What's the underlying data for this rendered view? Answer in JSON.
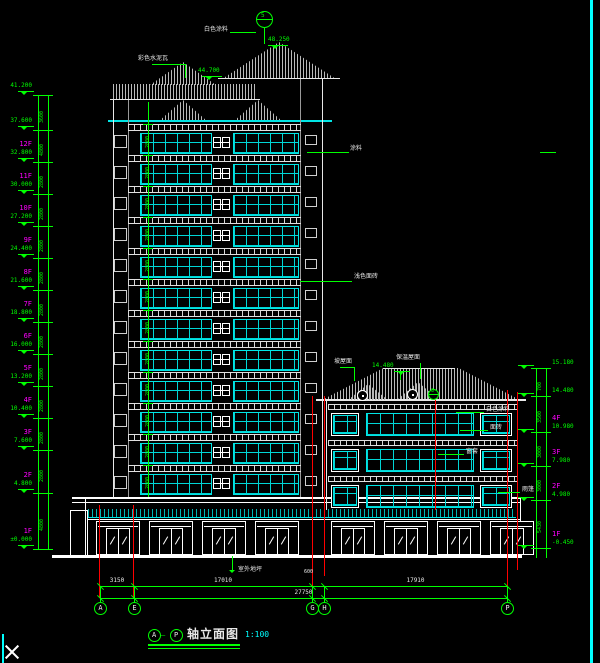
{
  "drawing": {
    "title_bubble_left": "A",
    "title_separator": "—",
    "title_bubble_right": "P",
    "title_text": "轴立面图",
    "title_scale": "1:100"
  },
  "colors": {
    "background": "#000000",
    "dimension_green": "#00ff00",
    "glazing_cyan": "#00e5e5",
    "floor_label_magenta": "#ff00ff",
    "grid_line_red": "#ff0000",
    "line_white": "#e8e8e8",
    "border_cyan": "#00ffff"
  },
  "left_levels": [
    {
      "label": "",
      "elev": "41.200",
      "h": "3600"
    },
    {
      "label": "",
      "elev": "37.600",
      "h": "4800"
    },
    {
      "label": "12F",
      "elev": "32.800",
      "h": "2800"
    },
    {
      "label": "11F",
      "elev": "30.000",
      "h": "2800"
    },
    {
      "label": "10F",
      "elev": "27.200",
      "h": "2800"
    },
    {
      "label": "9F",
      "elev": "24.400",
      "h": "2800"
    },
    {
      "label": "8F",
      "elev": "21.600",
      "h": "2800"
    },
    {
      "label": "7F",
      "elev": "18.800",
      "h": "2800"
    },
    {
      "label": "6F",
      "elev": "16.000",
      "h": "2800"
    },
    {
      "label": "5F",
      "elev": "13.200",
      "h": "2800"
    },
    {
      "label": "4F",
      "elev": "10.400",
      "h": "2800"
    },
    {
      "label": "3F",
      "elev": "7.600",
      "h": "2800"
    },
    {
      "label": "2F",
      "elev": "4.800",
      "h": "4800"
    },
    {
      "label": "1F",
      "elev": "±0.000",
      "h": ""
    }
  ],
  "right_levels": [
    {
      "label": "",
      "elev": "15.180",
      "h": "700"
    },
    {
      "label": "",
      "elev": "14.480",
      "h": "3500"
    },
    {
      "label": "4F",
      "elev": "10.980",
      "h": "3000"
    },
    {
      "label": "3F",
      "elev": "7.980",
      "h": "3000"
    },
    {
      "label": "2F",
      "elev": "4.980",
      "h": "5430"
    },
    {
      "label": "1F",
      "elev": "-0.450",
      "h": ""
    }
  ],
  "tower_floor_height": "2800",
  "annotations": [
    "彩色水泥瓦",
    "白色涂料",
    "48.250",
    "44.700",
    "浅色面砖",
    "坡屋面",
    "保温屋面",
    "14.480",
    "白色涂料",
    "面砖",
    "窗套",
    "室外地坪",
    "雨篷",
    "涂料"
  ],
  "detail_marks": [
    "5",
    "3"
  ],
  "bottom_dims": {
    "segments": [
      "3150",
      "17010",
      "600",
      "17910"
    ],
    "total": "27750"
  },
  "grid_bubbles": [
    "A",
    "E",
    "G",
    "H",
    "P"
  ]
}
